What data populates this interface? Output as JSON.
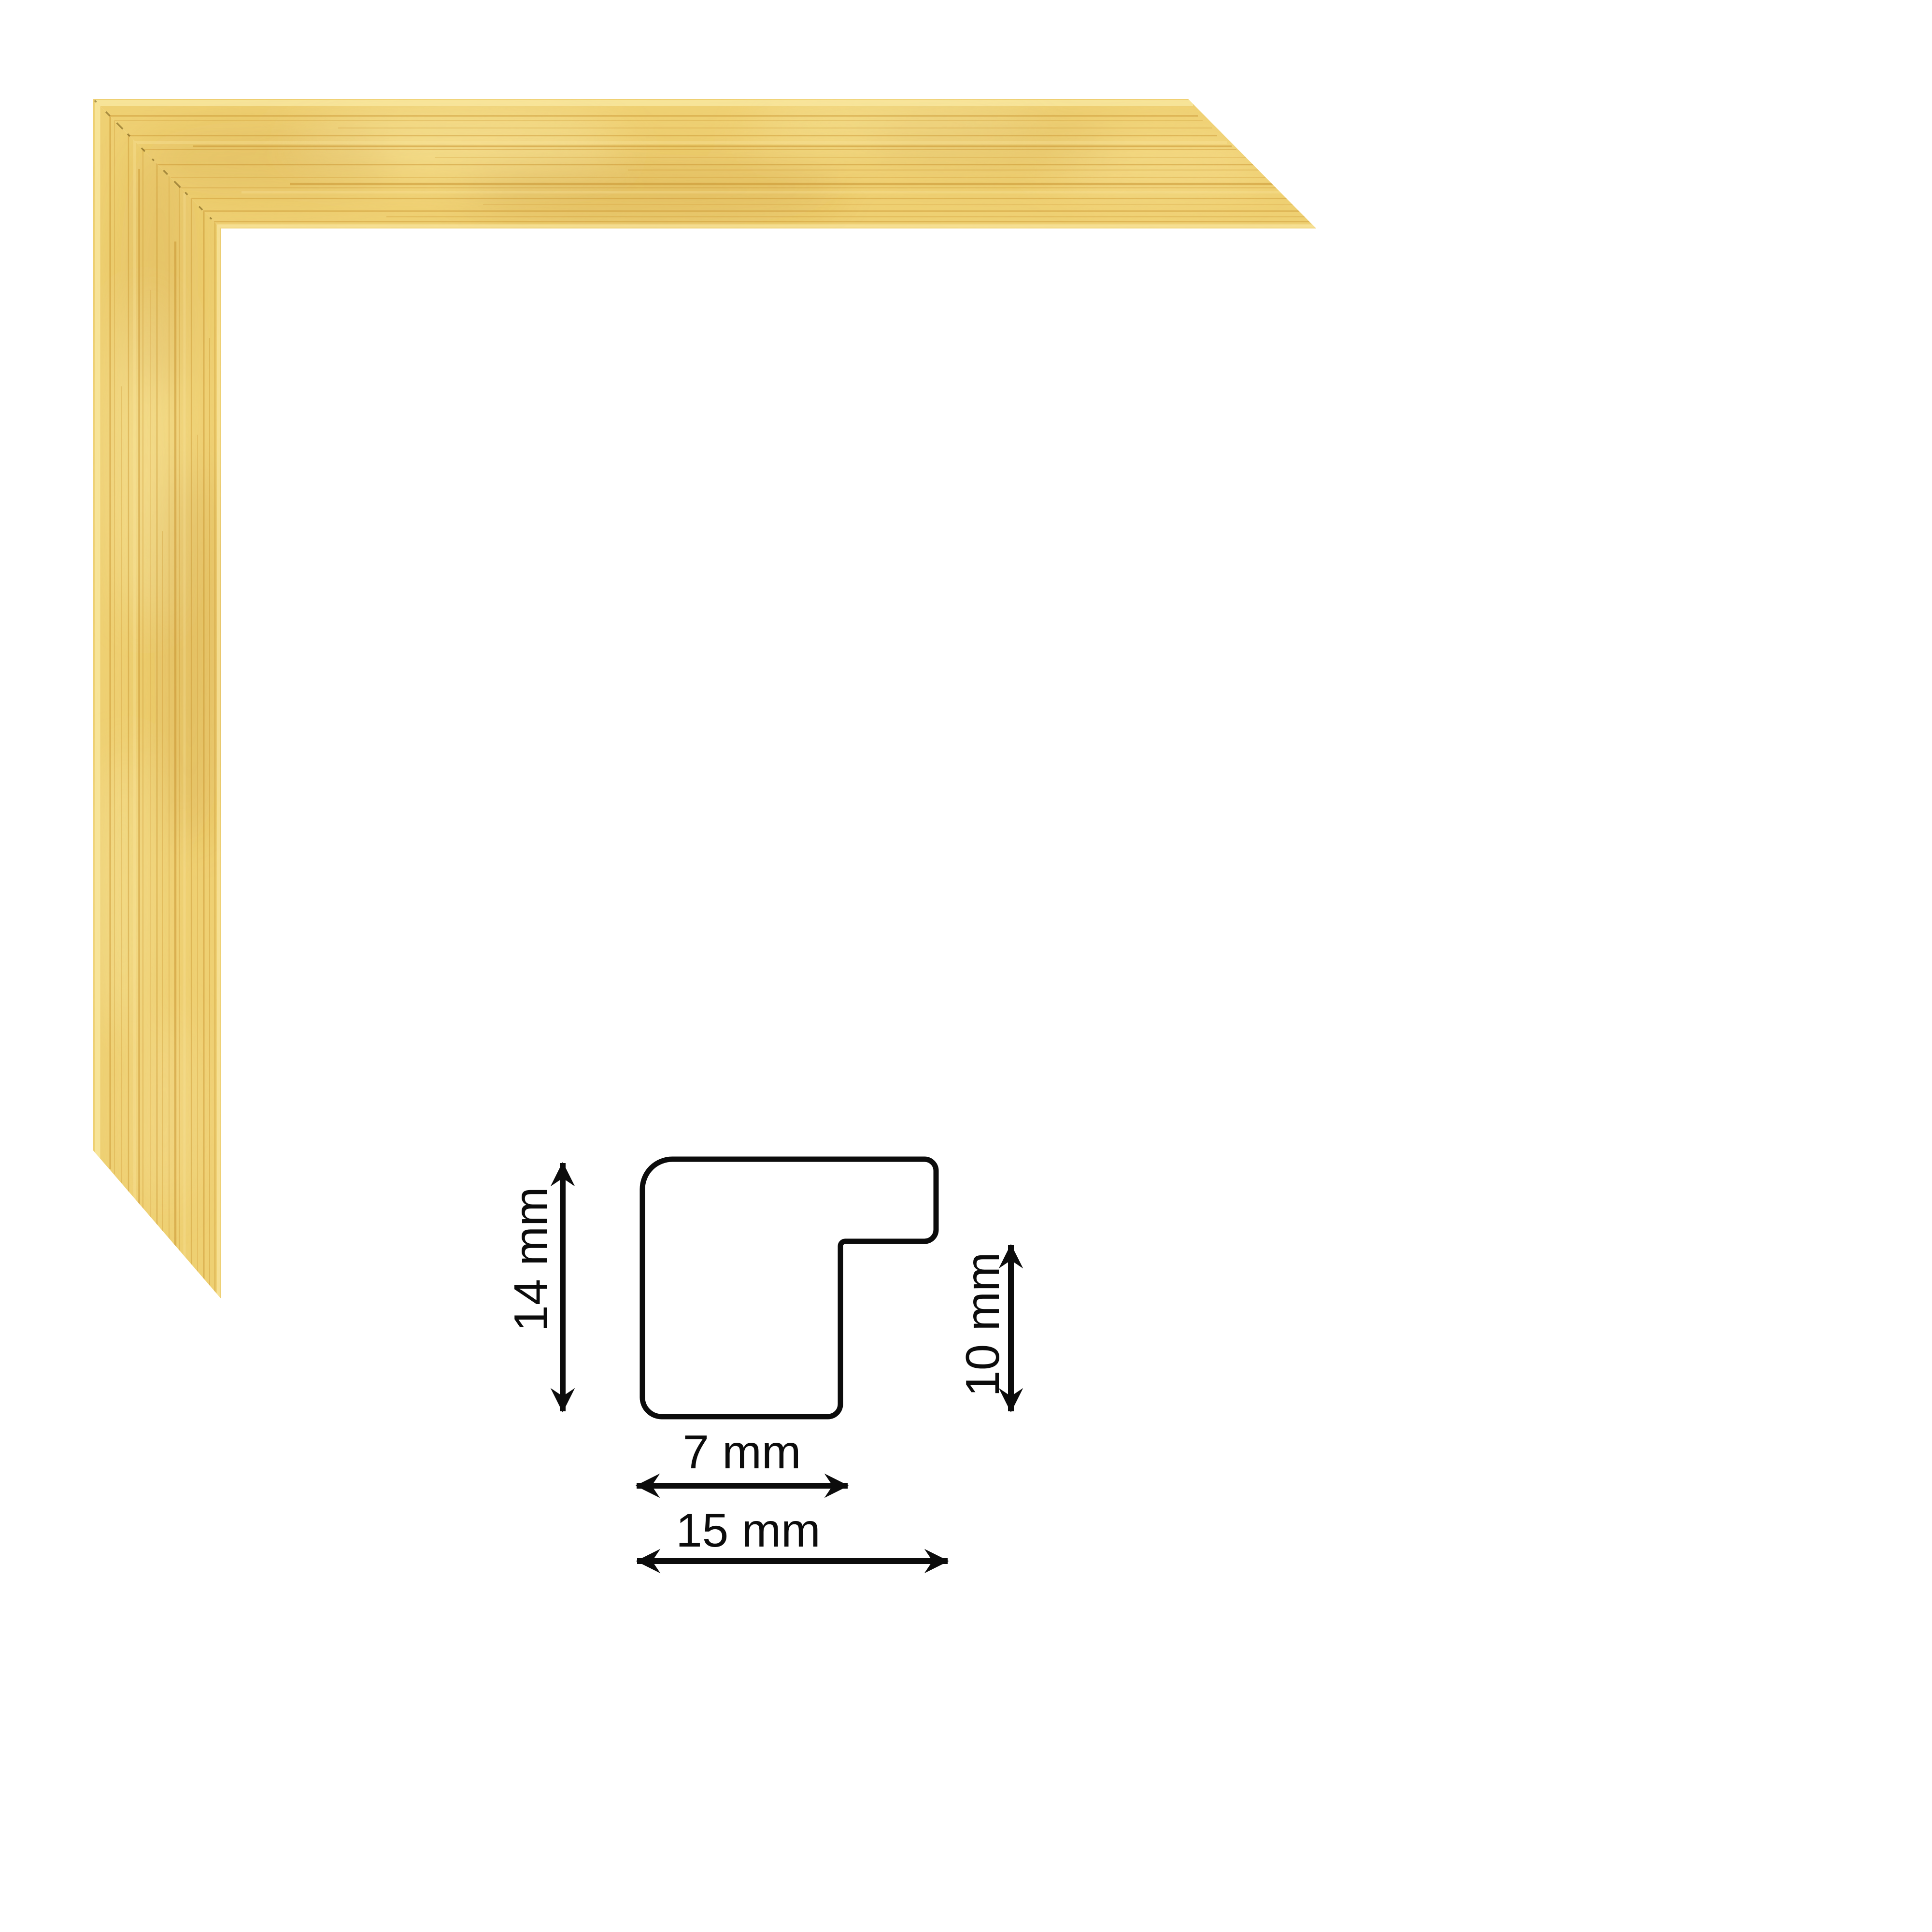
{
  "colors": {
    "page_bg": "#ffffff",
    "frame_gold_base": "#f0d173",
    "frame_gold_light": "#f8e69f",
    "frame_gold_streak": "#c68f2b",
    "frame_gold_deep": "#b8862c",
    "frame_seam": "#6b5212",
    "diagram_ink": "#0c0c0c"
  },
  "diagram": {
    "labels": {
      "total_height": "14 mm",
      "rabbet_depth": "10 mm",
      "face_width": "7 mm",
      "total_width": "15 mm"
    }
  }
}
